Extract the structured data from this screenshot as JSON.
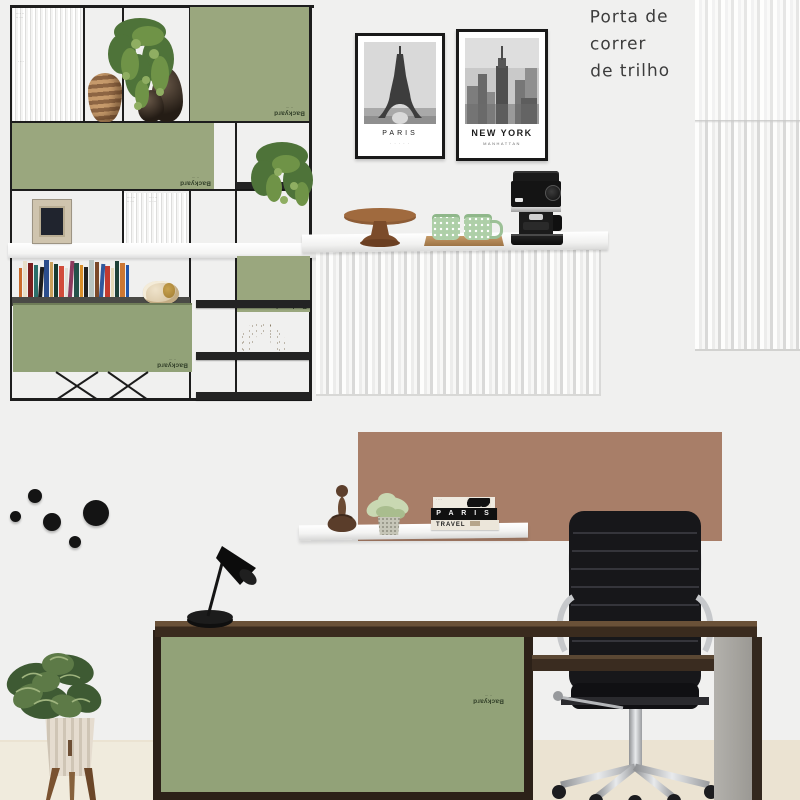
{
  "annotation": {
    "lines": [
      "Porta de",
      "correr",
      "de trilho"
    ]
  },
  "swatch": {
    "name": "Backyard",
    "brand_line": "·· ···",
    "micro_code": "···· ··\n·· ···"
  },
  "posters": {
    "paris": {
      "title": "PARIS",
      "subtitle": "· · · · ·"
    },
    "new_york": {
      "title": "NEW YORK",
      "subtitle": "MANHATTAN"
    }
  },
  "book_stack": {
    "top_text": "· ···",
    "middle_title": "P A R I S",
    "bottom_title": "TRAVEL"
  },
  "shelf_books": {
    "spine_colors": [
      "#c96a2a",
      "#e8dfc8",
      "#7a1f1f",
      "#2a6f6a",
      "#1c1c1c",
      "#2b4d8c",
      "#c9a05a",
      "#163a2e",
      "#d14b3a",
      "#e0e0d8",
      "#8c3b5e",
      "#23524a",
      "#d98f2b",
      "#202020",
      "#b8c4c0",
      "#7b4a2a",
      "#30589c",
      "#c23b2f",
      "#e3d9b8",
      "#1d4038",
      "#cc7733",
      "#2255aa"
    ]
  },
  "palette": {
    "wall": "#f0f0ef",
    "floor": "#ebe3d2",
    "floor_left": "#f0ebdd",
    "sage": "#9aa77e",
    "sage_desk": "#92a278",
    "terracotta": "#a87e68",
    "frame_black": "#1d1d1d",
    "wood_dark": "#3a2b1e",
    "chrome": "#c2c4c7",
    "mug_green": "#aecfa8"
  }
}
